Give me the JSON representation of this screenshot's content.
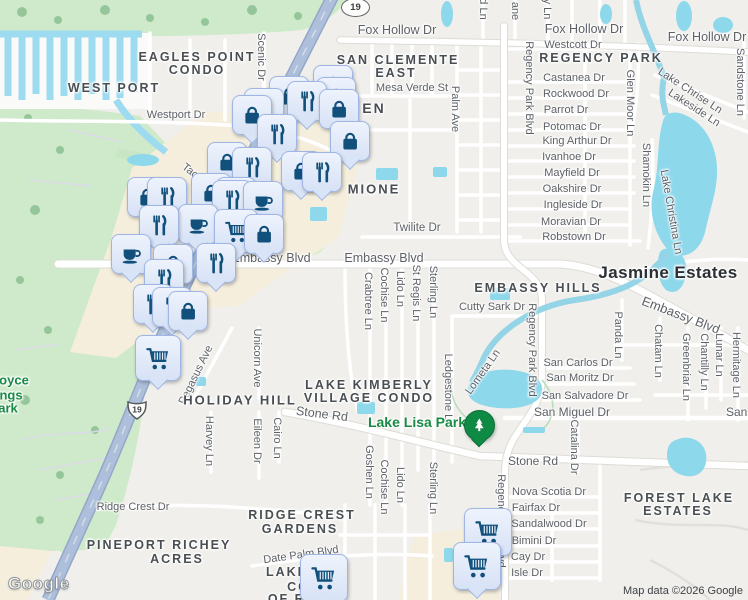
{
  "map": {
    "attribution": "Map data ©2026 Google",
    "logo": "Google",
    "colors": {
      "land": "#f0efeb",
      "park_green": "#cfeaca",
      "water": "#8ed8ec",
      "commercial": "#f5eedd",
      "highway": "#adbfda",
      "pin_fill": "#dce7f8",
      "pin_border": "#9fb6e4",
      "pin_glyph": "#11507b",
      "park_pin": "#0f8a44",
      "park_text": "#188a44"
    },
    "shields": [
      {
        "label": "19",
        "type": "oval",
        "x": 355,
        "y": 7
      },
      {
        "label": "19",
        "type": "us",
        "x": 137,
        "y": 410
      }
    ],
    "labels": [
      {
        "text": "Fox Hollow Dr",
        "x": 397,
        "y": 30,
        "cls": "st",
        "fs": 12.5
      },
      {
        "text": "Fox Hollow Dr",
        "x": 584,
        "y": 29,
        "cls": "st",
        "fs": 12.5
      },
      {
        "text": "Fox Hollow Dr",
        "x": 707,
        "y": 37,
        "cls": "st",
        "fs": 12.5
      },
      {
        "text": "Westcott Dr",
        "x": 573,
        "y": 45,
        "cls": "st"
      },
      {
        "text": "Castanea Dr",
        "x": 574,
        "y": 78,
        "cls": "st"
      },
      {
        "text": "Rockwood Dr",
        "x": 576,
        "y": 94,
        "cls": "st"
      },
      {
        "text": "Parrot Dr",
        "x": 566,
        "y": 110,
        "cls": "st"
      },
      {
        "text": "Potomac Dr",
        "x": 572,
        "y": 127,
        "cls": "st"
      },
      {
        "text": "King Arthur Dr",
        "x": 577,
        "y": 141,
        "cls": "st"
      },
      {
        "text": "Ivanhoe Dr",
        "x": 569,
        "y": 157,
        "cls": "st"
      },
      {
        "text": "Mayfield Dr",
        "x": 572,
        "y": 173,
        "cls": "st"
      },
      {
        "text": "Oakshire Dr",
        "x": 572,
        "y": 189,
        "cls": "st"
      },
      {
        "text": "Ingleside Dr",
        "x": 573,
        "y": 205,
        "cls": "st"
      },
      {
        "text": "Moravian Dr",
        "x": 571,
        "y": 222,
        "cls": "st"
      },
      {
        "text": "Robstown Dr",
        "x": 574,
        "y": 237,
        "cls": "st"
      },
      {
        "text": "Mesa Verde St",
        "x": 412,
        "y": 88,
        "cls": "st"
      },
      {
        "text": "Twilite Dr",
        "x": 417,
        "y": 228,
        "cls": "st",
        "fs": 11.5
      },
      {
        "text": "Embassy Blvd",
        "x": 271,
        "y": 258,
        "cls": "st",
        "fs": 12.5
      },
      {
        "text": "Embassy Blvd",
        "x": 384,
        "y": 258,
        "cls": "st",
        "fs": 12.5
      },
      {
        "text": "Embassy Blvd",
        "x": 681,
        "y": 315,
        "cls": "st",
        "fs": 13,
        "rot": 21
      },
      {
        "text": "Cutty Sark Dr",
        "x": 492,
        "y": 307,
        "cls": "st"
      },
      {
        "text": "San Carlos Dr",
        "x": 578,
        "y": 363,
        "cls": "st"
      },
      {
        "text": "San Moritz Dr",
        "x": 580,
        "y": 378,
        "cls": "st"
      },
      {
        "text": "San Salvadore Dr",
        "x": 585,
        "y": 396,
        "cls": "st"
      },
      {
        "text": "San Miguel Dr",
        "x": 572,
        "y": 412,
        "cls": "st",
        "fs": 12
      },
      {
        "text": "San Miguel Dr",
        "x": 764,
        "y": 412,
        "cls": "st",
        "fs": 12
      },
      {
        "text": "Stone Rd",
        "x": 322,
        "y": 414,
        "cls": "st",
        "fs": 12.5,
        "rot": 7
      },
      {
        "text": "Stone Rd",
        "x": 533,
        "y": 461,
        "cls": "st",
        "fs": 12
      },
      {
        "text": "Westport Dr",
        "x": 176,
        "y": 115,
        "cls": "st"
      },
      {
        "text": "Ridge Crest Dr",
        "x": 133,
        "y": 507,
        "cls": "st"
      },
      {
        "text": "Date Palm Blvd",
        "x": 301,
        "y": 555,
        "cls": "st",
        "rot": -8
      },
      {
        "text": "Nova Scotia Dr",
        "x": 549,
        "y": 492,
        "cls": "st"
      },
      {
        "text": "Fairfax Dr",
        "x": 536,
        "y": 508,
        "cls": "st"
      },
      {
        "text": "Sandalwood Dr",
        "x": 549,
        "y": 524,
        "cls": "st"
      },
      {
        "text": "Bimini Dr",
        "x": 534,
        "y": 541,
        "cls": "st"
      },
      {
        "text": "Cay Dr",
        "x": 528,
        "y": 557,
        "cls": "st"
      },
      {
        "text": "Isle Dr",
        "x": 527,
        "y": 573,
        "cls": "st"
      },
      {
        "text": "Tac",
        "x": 190,
        "y": 171,
        "cls": "st",
        "rot": 38
      },
      {
        "text": "Scenic Dr",
        "x": 261,
        "y": 57,
        "cls": "st",
        "rot": 90
      },
      {
        "text": "Palm Ave",
        "x": 455,
        "y": 109,
        "cls": "st",
        "rot": 90
      },
      {
        "text": "d Ln",
        "x": 483,
        "y": 9,
        "cls": "st",
        "rot": 90
      },
      {
        "text": "ane",
        "x": 515,
        "y": 11,
        "cls": "st",
        "rot": 90
      },
      {
        "text": "y Ln",
        "x": 547,
        "y": 9,
        "cls": "st",
        "rot": 90
      },
      {
        "text": "Regency Park Blvd",
        "x": 529,
        "y": 88,
        "cls": "st",
        "rot": 90
      },
      {
        "text": "Glen Moor Ln",
        "x": 630,
        "y": 103,
        "cls": "st",
        "rot": 90
      },
      {
        "text": "Shamokin Ln",
        "x": 646,
        "y": 175,
        "cls": "st",
        "rot": 90
      },
      {
        "text": "Lake Christina Ln",
        "x": 671,
        "y": 212,
        "cls": "st",
        "rot": 80
      },
      {
        "text": "Sandstone Ln",
        "x": 740,
        "y": 82,
        "cls": "st",
        "rot": 90
      },
      {
        "text": "Lake Chrise Ln",
        "x": 690,
        "y": 91,
        "cls": "st",
        "rot": 33
      },
      {
        "text": "Lakeside Ln",
        "x": 694,
        "y": 108,
        "cls": "st",
        "rot": 33
      },
      {
        "text": "Crabtree Ln",
        "x": 368,
        "y": 301,
        "cls": "st",
        "rot": 90
      },
      {
        "text": "Cochise Ln",
        "x": 384,
        "y": 295,
        "cls": "st",
        "rot": 90
      },
      {
        "text": "Lido Ln",
        "x": 400,
        "y": 289,
        "cls": "st",
        "rot": 90
      },
      {
        "text": "St Regis Ln",
        "x": 416,
        "y": 293,
        "cls": "st",
        "rot": 90
      },
      {
        "text": "Sterling Ln",
        "x": 433,
        "y": 292,
        "cls": "st",
        "rot": 90
      },
      {
        "text": "Regency Park Blvd",
        "x": 532,
        "y": 350,
        "cls": "st",
        "rot": 90
      },
      {
        "text": "Panda Ln",
        "x": 618,
        "y": 335,
        "cls": "st",
        "rot": 90
      },
      {
        "text": "Chatam Ln",
        "x": 658,
        "y": 351,
        "cls": "st",
        "rot": 90
      },
      {
        "text": "Greenbriar Ln",
        "x": 686,
        "y": 367,
        "cls": "st",
        "rot": 90
      },
      {
        "text": "Chantilly Ln",
        "x": 704,
        "y": 362,
        "cls": "st",
        "rot": 90
      },
      {
        "text": "Lunar Ln",
        "x": 719,
        "y": 355,
        "cls": "st",
        "rot": 90
      },
      {
        "text": "Hermitage Ln",
        "x": 736,
        "y": 365,
        "cls": "st",
        "rot": 90
      },
      {
        "text": "Ledgestone Ln",
        "x": 448,
        "y": 390,
        "cls": "st",
        "rot": 90
      },
      {
        "text": "Lometa Ln",
        "x": 483,
        "y": 372,
        "cls": "st",
        "rot": -55
      },
      {
        "text": "Unicorn Ave",
        "x": 257,
        "y": 358,
        "cls": "st",
        "rot": 90
      },
      {
        "text": "Pegasus Ave",
        "x": 196,
        "y": 375,
        "cls": "st",
        "rot": -64
      },
      {
        "text": "Harvey Ln",
        "x": 209,
        "y": 441,
        "cls": "st",
        "rot": 90
      },
      {
        "text": "Eileen Dr",
        "x": 257,
        "y": 441,
        "cls": "st",
        "rot": 90
      },
      {
        "text": "Cairo Ln",
        "x": 277,
        "y": 438,
        "cls": "st",
        "rot": 90
      },
      {
        "text": "Goshen Ln",
        "x": 369,
        "y": 472,
        "cls": "st",
        "rot": 90
      },
      {
        "text": "Cochise Ln",
        "x": 384,
        "y": 487,
        "cls": "st",
        "rot": 90
      },
      {
        "text": "Lido Ln",
        "x": 400,
        "y": 485,
        "cls": "st",
        "rot": 90
      },
      {
        "text": "Sterling Ln",
        "x": 433,
        "y": 488,
        "cls": "st",
        "rot": 90
      },
      {
        "text": "Catalina Dr",
        "x": 574,
        "y": 447,
        "cls": "st",
        "rot": 90
      },
      {
        "text": "Regency Park Blvd",
        "x": 501,
        "y": 521,
        "cls": "st",
        "rot": 90
      },
      {
        "text": "EAGLES POINT",
        "x": 197,
        "y": 57,
        "cls": "nb"
      },
      {
        "text": "CONDO",
        "x": 197,
        "y": 70,
        "cls": "nb"
      },
      {
        "text": "WEST PORT",
        "x": 114,
        "y": 88,
        "cls": "nb"
      },
      {
        "text": "SAN CLEMENTE",
        "x": 398,
        "y": 60,
        "cls": "nb"
      },
      {
        "text": "EAST",
        "x": 396,
        "y": 73,
        "cls": "nb"
      },
      {
        "text": "REGENCY PARK",
        "x": 601,
        "y": 58,
        "cls": "nb"
      },
      {
        "text": "EN",
        "x": 374,
        "y": 108,
        "cls": "nb",
        "fs": 14
      },
      {
        "text": "MIONE",
        "x": 374,
        "y": 189,
        "cls": "nb",
        "fs": 13
      },
      {
        "text": "EMBASSY HILLS",
        "x": 538,
        "y": 288,
        "cls": "nb"
      },
      {
        "text": "HOLIDAY HILL",
        "x": 240,
        "y": 400,
        "cls": "nb",
        "fs": 13
      },
      {
        "text": "LAKE KIMBERLY",
        "x": 369,
        "y": 385,
        "cls": "nb"
      },
      {
        "text": "VILLAGE CONDO",
        "x": 369,
        "y": 398,
        "cls": "nb"
      },
      {
        "text": "RIDGE CREST",
        "x": 302,
        "y": 515,
        "cls": "nb"
      },
      {
        "text": "GARDENS",
        "x": 300,
        "y": 529,
        "cls": "nb"
      },
      {
        "text": "PINEPORT RICHEY",
        "x": 159,
        "y": 545,
        "cls": "nb"
      },
      {
        "text": "ACRES",
        "x": 177,
        "y": 559,
        "cls": "nb"
      },
      {
        "text": "FOREST LAKE",
        "x": 679,
        "y": 498,
        "cls": "nb"
      },
      {
        "text": "ESTATES",
        "x": 678,
        "y": 511,
        "cls": "nb"
      },
      {
        "text": "LAKE",
        "x": 287,
        "y": 572,
        "cls": "nb"
      },
      {
        "text": "CON",
        "x": 304,
        "y": 587,
        "cls": "nb"
      },
      {
        "text": "OF RID",
        "x": 295,
        "y": 599,
        "cls": "nb"
      },
      {
        "text": "Jasmine Estates",
        "x": 668,
        "y": 273,
        "cls": "city"
      },
      {
        "text": "Lake Lisa Park",
        "x": 417,
        "y": 422,
        "cls": "pk",
        "fs": 14
      },
      {
        "text": "oyce",
        "x": 14,
        "y": 380,
        "cls": "pk"
      },
      {
        "text": "ngs",
        "x": 11,
        "y": 395,
        "cls": "pk"
      },
      {
        "text": "ark",
        "x": 8,
        "y": 408,
        "cls": "pk"
      }
    ],
    "markers": [
      {
        "icon": "bag",
        "x": 332,
        "y": 84
      },
      {
        "icon": "bag",
        "x": 335,
        "y": 96
      },
      {
        "icon": "bag",
        "x": 288,
        "y": 95
      },
      {
        "icon": "fork",
        "x": 306,
        "y": 100
      },
      {
        "icon": "bag",
        "x": 338,
        "y": 108
      },
      {
        "icon": "fork",
        "x": 263,
        "y": 107
      },
      {
        "icon": "bag",
        "x": 251,
        "y": 114
      },
      {
        "icon": "fork",
        "x": 276,
        "y": 133
      },
      {
        "icon": "bag",
        "x": 349,
        "y": 140
      },
      {
        "icon": "bag",
        "x": 226,
        "y": 161
      },
      {
        "icon": "fork",
        "x": 251,
        "y": 166
      },
      {
        "icon": "bag",
        "x": 300,
        "y": 170
      },
      {
        "icon": "fork",
        "x": 321,
        "y": 171
      },
      {
        "icon": "bag",
        "x": 210,
        "y": 192
      },
      {
        "icon": "fork",
        "x": 235,
        "y": 196
      },
      {
        "icon": "bag",
        "x": 146,
        "y": 196
      },
      {
        "icon": "fork",
        "x": 166,
        "y": 196
      },
      {
        "icon": "fork",
        "x": 231,
        "y": 199
      },
      {
        "icon": "coffee",
        "x": 262,
        "y": 200
      },
      {
        "icon": "coffee",
        "x": 197,
        "y": 223
      },
      {
        "icon": "fork",
        "x": 158,
        "y": 224
      },
      {
        "icon": "cart",
        "x": 235,
        "y": 230,
        "size": 42
      },
      {
        "icon": "bag",
        "x": 263,
        "y": 233
      },
      {
        "icon": "coffee",
        "x": 130,
        "y": 253
      },
      {
        "icon": "bag",
        "x": 172,
        "y": 263
      },
      {
        "icon": "fork",
        "x": 215,
        "y": 262
      },
      {
        "icon": "fork",
        "x": 163,
        "y": 278
      },
      {
        "icon": "fork",
        "x": 152,
        "y": 303
      },
      {
        "icon": "fork",
        "x": 171,
        "y": 306
      },
      {
        "icon": "bag",
        "x": 187,
        "y": 310
      },
      {
        "icon": "cart",
        "x": 157,
        "y": 357,
        "size": 44
      },
      {
        "icon": "park",
        "x": 478,
        "y": 424,
        "size": 29
      },
      {
        "icon": "cart",
        "x": 487,
        "y": 531,
        "size": 46
      },
      {
        "icon": "cart",
        "x": 476,
        "y": 565,
        "size": 46
      },
      {
        "icon": "cart",
        "x": 323,
        "y": 577,
        "size": 46
      }
    ]
  }
}
